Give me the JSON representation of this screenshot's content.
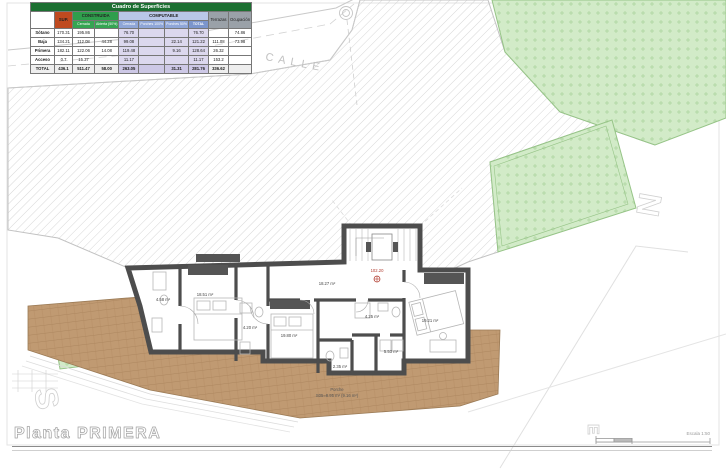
{
  "sheet": {
    "plan_title": "Planta PRIMERA",
    "scale_label": "Escala 1:50",
    "street_label": "CALLE",
    "level_marker": "102.20",
    "porch_label_1": "Porche",
    "porch_label_2": "S05=8.95 m² (9.16 m²)",
    "compass_n": "N",
    "compass_s": "S",
    "compass_e": "E"
  },
  "table": {
    "title": "Cuadro de Superficies",
    "groups": {
      "sup": "SUP.",
      "construida": "CONSTRUIDA",
      "computable": "COMPUTABLE",
      "terrazas": "Terrazas",
      "ocupacion": "Ocupación"
    },
    "subs": [
      "Cerrada",
      "Abierta (50%)",
      "Cerrada",
      "Porches 100%",
      "Porches 50%",
      "TOTAL"
    ],
    "rows": [
      {
        "label": "Sótano",
        "cells": [
          "170.31",
          "195.86",
          "",
          "76.70",
          "",
          "",
          "76.70",
          "",
          "74.86"
        ]
      },
      {
        "label": "Baja",
        "cells": [
          "134.21",
          "112.08",
          "44.28",
          "99.08",
          "",
          "22.14",
          "121.22",
          "111.08",
          "73.98"
        ]
      },
      {
        "label": "Primera",
        "cells": [
          "182.11",
          "122.06",
          "14.08",
          "119.48",
          "",
          "9.16",
          "128.64",
          "26.32",
          ""
        ]
      },
      {
        "label": "Acceso",
        "cells": [
          "0.7",
          "15.37",
          "",
          "11.17",
          "",
          "",
          "11.17",
          "153.2",
          ""
        ]
      },
      {
        "label": "TOTAL",
        "cells": [
          "436.1",
          "511.47",
          "58.00",
          "263.05",
          "",
          "31.31",
          "281.76",
          "336.62",
          ""
        ]
      }
    ]
  },
  "rooms": [
    {
      "name": "bathroom-1",
      "area": "4.58 m²"
    },
    {
      "name": "bedroom-1",
      "area": "18.51 m²"
    },
    {
      "name": "bathroom-2",
      "area": "4.20 m²"
    },
    {
      "name": "bedroom-2",
      "area": "19.80 m²"
    },
    {
      "name": "hall",
      "area": "18.27 m²"
    },
    {
      "name": "bathroom-3",
      "area": "4.25 m²"
    },
    {
      "name": "laundry",
      "area": "5.53 m²"
    },
    {
      "name": "wc",
      "area": "2.35 m²"
    },
    {
      "name": "bedroom-3",
      "area": "19.21 m²"
    }
  ],
  "colors": {
    "table_title_bg": "#1c6f31",
    "sup_header_bg": "#bf4a1f",
    "construida_header_bg": "#2f9e4c",
    "computable_header_bg": "#b9c7e8",
    "computable_cell_bg": "#dcd8ee",
    "grey_header_bg": "#9aa1a8",
    "deck_wood": "#c09a72",
    "vegetation_green": "#d2ebc8",
    "wall_grey": "#4d4d4d",
    "level_marker_red": "#b03a2e"
  }
}
